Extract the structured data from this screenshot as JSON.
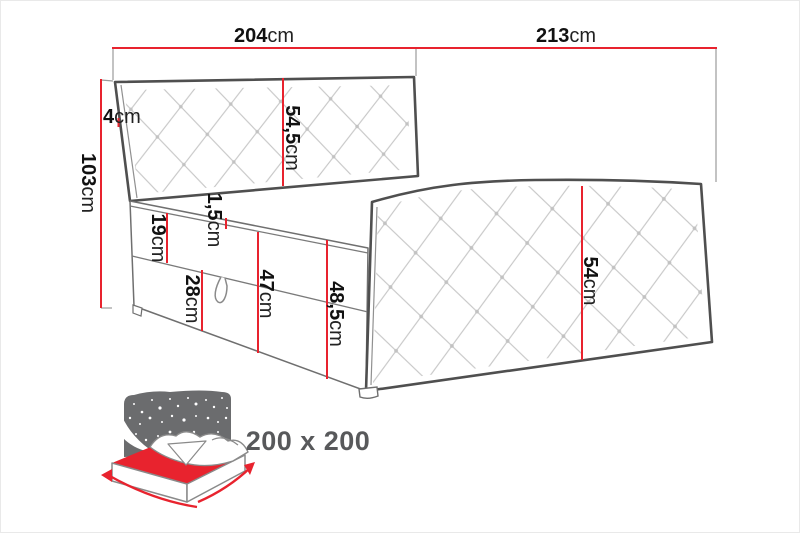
{
  "dimensions": {
    "width": {
      "value": "204",
      "unit": "cm"
    },
    "depth": {
      "value": "213",
      "unit": "cm"
    },
    "headboard_edge": {
      "value": "4",
      "unit": "cm"
    },
    "total_height": {
      "value": "103",
      "unit": "cm"
    },
    "headboard_panel": {
      "value": "54,5",
      "unit": "cm"
    },
    "mattress_layer": {
      "value": "19",
      "unit": "cm"
    },
    "topper_layer": {
      "value": "1,5",
      "unit": "cm"
    },
    "storage_box": {
      "value": "28",
      "unit": "cm"
    },
    "base_side": {
      "value": "47",
      "unit": "cm"
    },
    "base_side_total": {
      "value": "48,5",
      "unit": "cm"
    },
    "side_panel": {
      "value": "54",
      "unit": "cm"
    }
  },
  "sleeping_area": {
    "label": "200 x 200"
  },
  "colors": {
    "dimension_line": "#e8232e",
    "outline_dark": "#4f4f4f",
    "quilt_line": "#c6c6c6",
    "icon_gray": "#6b6c6e",
    "size_label_text": "#58595b"
  }
}
